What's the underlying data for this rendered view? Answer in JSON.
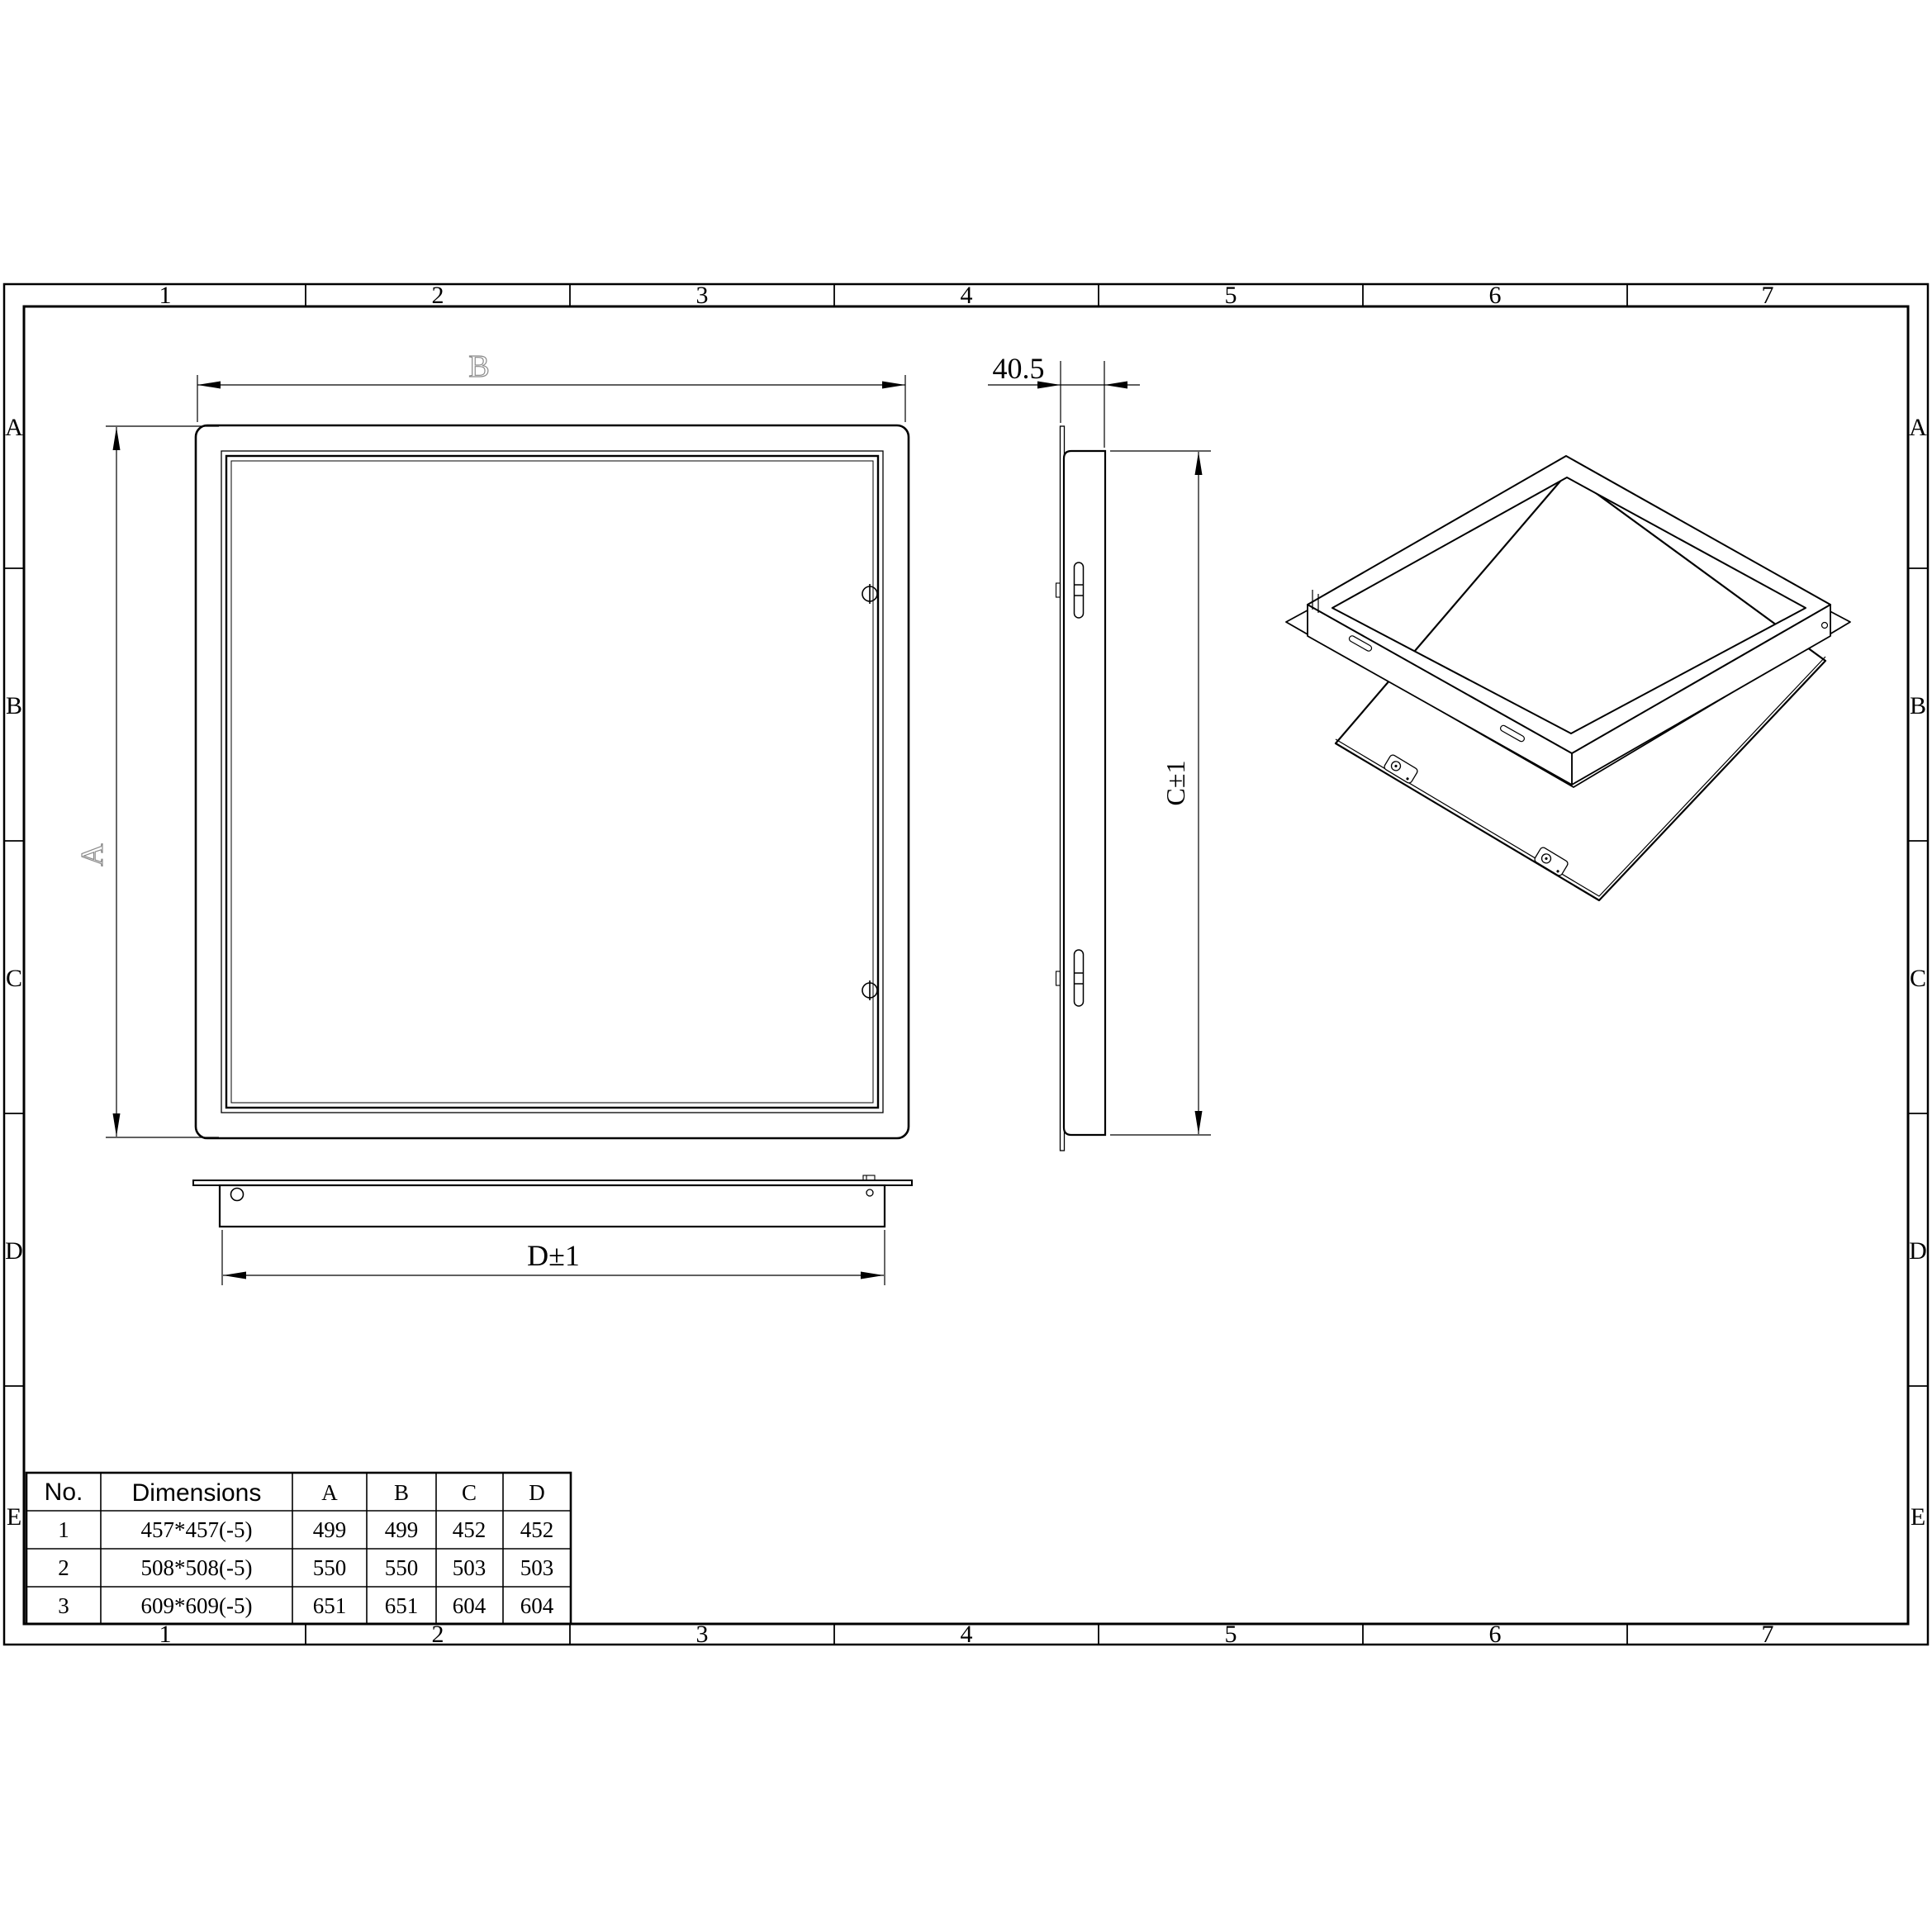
{
  "drawing": {
    "grid_columns": [
      "1",
      "2",
      "3",
      "4",
      "5",
      "6",
      "7"
    ],
    "grid_rows": [
      "A",
      "B",
      "C",
      "D",
      "E"
    ],
    "dimensions": {
      "face_width_label": "B",
      "face_height_label": "A",
      "depth_label": "40.5",
      "frame_height_label": "C±1",
      "frame_width_label": "D±1"
    },
    "table": {
      "headers": {
        "no": "No.",
        "dimensions": "Dimensions",
        "a": "A",
        "b": "B",
        "c": "C",
        "d": "D"
      },
      "rows": [
        {
          "no": "1",
          "dimensions": "457*457(-5)",
          "a": "499",
          "b": "499",
          "c": "452",
          "d": "452"
        },
        {
          "no": "2",
          "dimensions": "508*508(-5)",
          "a": "550",
          "b": "550",
          "c": "503",
          "d": "503"
        },
        {
          "no": "3",
          "dimensions": "609*609(-5)",
          "a": "651",
          "b": "651",
          "c": "604",
          "d": "604"
        }
      ]
    },
    "colors": {
      "line": "#000000",
      "dim_label_gray": "#8a8a8a",
      "background": "#ffffff"
    }
  }
}
